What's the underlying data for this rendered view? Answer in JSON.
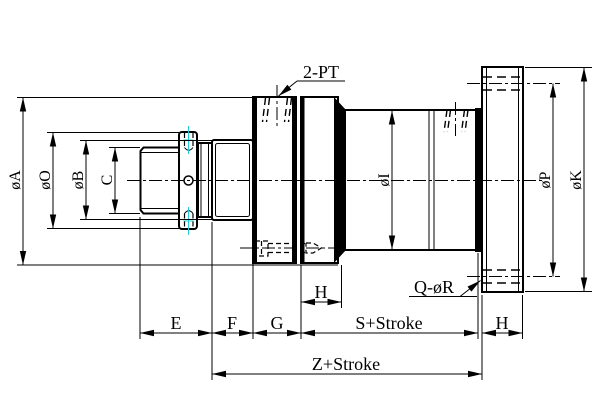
{
  "drawing": {
    "colors": {
      "line": "#000000",
      "background": "#ffffff",
      "center_mark": "#1fcdd8"
    },
    "dimension_labels": {
      "dia_a": "øA",
      "dia_o": "øO",
      "dia_b": "øB",
      "c": "C",
      "dia_i": "øI",
      "dia_p": "øP",
      "dia_k": "øK",
      "e": "E",
      "f": "F",
      "g": "G",
      "h_head": "H",
      "h_flange": "H",
      "s_stroke": "S+Stroke",
      "z_stroke": "Z+Stroke"
    },
    "callouts": {
      "ports": "2-PT",
      "bolt_holes": "Q-øR"
    }
  }
}
